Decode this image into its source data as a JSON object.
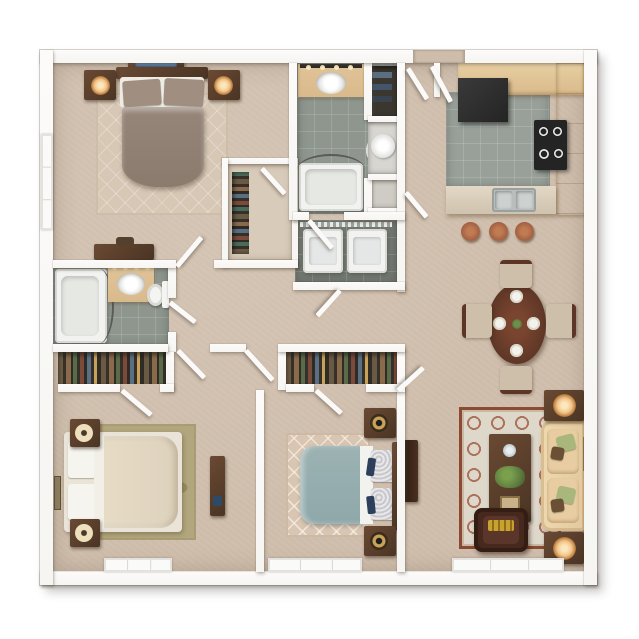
{
  "scene": {
    "kind": "3d-rendered-apartment-floor-plan",
    "view": "top-down",
    "visible_bedrooms": 3,
    "visible_bathrooms": 2
  },
  "palette": {
    "wall": "#f6f5f2",
    "carpet": "#cfbdab",
    "tile": "#8e968e",
    "tiledark": "#747a73",
    "counter": "#d9ba8c",
    "wooddark": "#4a3424",
    "woodmid": "#6a4a33",
    "duvetmaster": "#8b7b6d",
    "pillowtaupe": "#a08f80",
    "duvetteal": "#8fa8aa",
    "bedcream": "#ddd2bd",
    "rugolive": "#b1a67d",
    "sofatan": "#e3c89d",
    "chairbrown": "#46281d",
    "pillowgreen": "#a9b77c",
    "ruglivingbg": "#ded8cb",
    "ruglivingaccent": "#9e5138",
    "lamp": "#f2c488",
    "stool": "#a05f41",
    "screenblue": "#5b80a8",
    "navy": "#2e3f5c",
    "plant": "#5f7d3f",
    "applianceblack": "#242424"
  },
  "rooms": [
    {
      "name": "master-bedroom",
      "furniture": [
        "bed",
        "tv-dresser",
        "nightstand-left",
        "nightstand-right",
        "area-rug",
        "desk",
        "window",
        "walk-in-closet"
      ]
    },
    {
      "name": "hall-bathroom",
      "furniture": [
        "vanity-sink",
        "toilet",
        "bathtub",
        "shower-rod"
      ]
    },
    {
      "name": "utility-closets",
      "furniture": [
        "linen-shelves",
        "water-heater",
        "storage-shelf"
      ]
    },
    {
      "name": "laundry-closet",
      "furniture": [
        "washer",
        "dryer",
        "wire-shelf"
      ]
    },
    {
      "name": "kitchen",
      "furniture": [
        "refrigerator",
        "stove",
        "counters",
        "double-sink",
        "breakfast-bar",
        "bar-stools"
      ]
    },
    {
      "name": "entry-foyer",
      "furniture": [
        "entry-double-doors"
      ]
    },
    {
      "name": "dining-area",
      "furniture": [
        "oval-table",
        "four-chairs",
        "place-settings"
      ]
    },
    {
      "name": "living-room",
      "furniture": [
        "sofa",
        "coffee-table",
        "armchair",
        "end-table-lamps",
        "tv-console",
        "area-rug",
        "wall-art",
        "sliding-window"
      ]
    },
    {
      "name": "second-bathroom",
      "furniture": [
        "bathtub",
        "vanity-sink",
        "toilet",
        "vanity-lights"
      ]
    },
    {
      "name": "bedroom-two",
      "furniture": [
        "teal-bed",
        "nightstands",
        "lattice-rug",
        "closet",
        "window"
      ]
    },
    {
      "name": "bedroom-three",
      "furniture": [
        "cream-bed",
        "nightstands",
        "olive-rug",
        "desk",
        "closet",
        "window",
        "wall-art"
      ]
    }
  ]
}
